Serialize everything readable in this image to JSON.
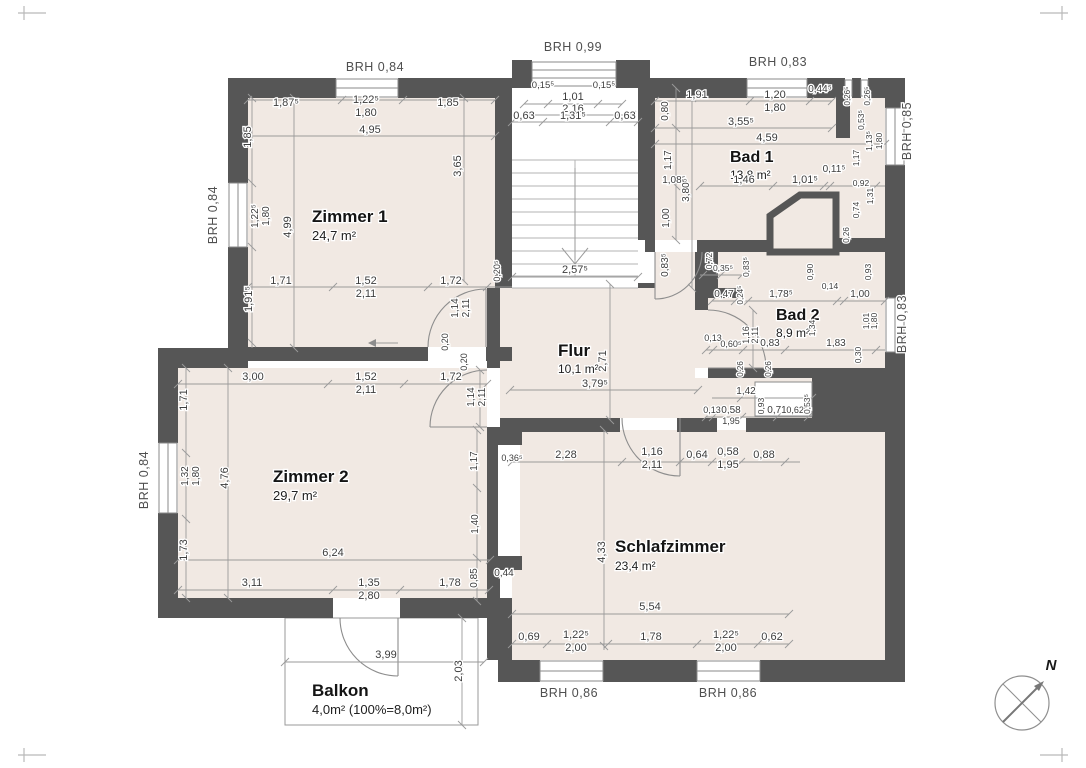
{
  "document_type": "floor-plan",
  "colors": {
    "wall": "#565656",
    "room_fill": "#f1e9e3",
    "dim_line": "#9a9a9a",
    "dim_text": "#3d3d3d",
    "paper": "#ffffff"
  },
  "rooms": [
    {
      "name": "Zimmer 1",
      "area": "24,7 m²"
    },
    {
      "name": "Zimmer 2",
      "area": "29,7 m²"
    },
    {
      "name": "Flur",
      "area": "10,1 m²"
    },
    {
      "name": "Bad 1",
      "area": "13,8 m²"
    },
    {
      "name": "Bad 2",
      "area": "8,9 m²"
    },
    {
      "name": "Schlafzimmer",
      "area": "23,4 m²"
    },
    {
      "name": "Balkon",
      "area": "4,0m² (100%=8,0m²)"
    }
  ],
  "plan": {
    "labels": [
      {
        "t": "Zimmer 1",
        "x": 312,
        "y": 222,
        "s": 17,
        "k": "room"
      },
      {
        "t": "24,7 m²",
        "x": 312,
        "y": 240,
        "s": 13,
        "k": "area"
      },
      {
        "t": "Zimmer 2",
        "x": 273,
        "y": 482,
        "s": 17,
        "k": "room"
      },
      {
        "t": "29,7 m²",
        "x": 273,
        "y": 500,
        "s": 13,
        "k": "area"
      },
      {
        "t": "Flur",
        "x": 558,
        "y": 356,
        "s": 17,
        "k": "room"
      },
      {
        "t": "10,1 m²",
        "x": 558,
        "y": 373,
        "s": 12,
        "k": "area"
      },
      {
        "t": "Bad 1",
        "x": 730,
        "y": 162,
        "s": 16,
        "k": "room"
      },
      {
        "t": "13,8 m²",
        "x": 730,
        "y": 179,
        "s": 12,
        "k": "area"
      },
      {
        "t": "Bad 2",
        "x": 776,
        "y": 320,
        "s": 16,
        "k": "room"
      },
      {
        "t": "8,9 m²",
        "x": 776,
        "y": 337,
        "s": 12,
        "k": "area"
      },
      {
        "t": "Schlafzimmer",
        "x": 615,
        "y": 552,
        "s": 17,
        "k": "room"
      },
      {
        "t": "23,4 m²",
        "x": 615,
        "y": 570,
        "s": 12,
        "k": "area"
      },
      {
        "t": "Balkon",
        "x": 312,
        "y": 696,
        "s": 17,
        "k": "room"
      },
      {
        "t": "4,0m² (100%=8,0m²)",
        "x": 312,
        "y": 714,
        "s": 13,
        "k": "area"
      },
      {
        "t": "BRH 0,84",
        "x": 375,
        "y": 71,
        "s": 12.5,
        "k": "brh"
      },
      {
        "t": "BRH 0,99",
        "x": 573,
        "y": 51,
        "s": 12.5,
        "k": "brh"
      },
      {
        "t": "BRH 0,83",
        "x": 778,
        "y": 66,
        "s": 12.5,
        "k": "brh"
      },
      {
        "t": "BRH 0,84",
        "x": 217,
        "y": 215,
        "r": 1,
        "s": 12.5,
        "k": "brh"
      },
      {
        "t": "BRH 0,84",
        "x": 148,
        "y": 480,
        "r": 1,
        "s": 12.5,
        "k": "brh"
      },
      {
        "t": "BRH 0,85",
        "x": 911,
        "y": 131,
        "r": 1,
        "s": 12.5,
        "k": "brh"
      },
      {
        "t": "BRH 0,83",
        "x": 906,
        "y": 324,
        "r": 1,
        "s": 12.5,
        "k": "brh"
      },
      {
        "t": "BRH 0,86",
        "x": 569,
        "y": 697,
        "s": 12.5,
        "k": "brh"
      },
      {
        "t": "BRH 0,86",
        "x": 728,
        "y": 697,
        "s": 12.5,
        "k": "brh"
      },
      {
        "t": "N",
        "x": 1051,
        "y": 670,
        "s": 15,
        "k": "compass"
      },
      {
        "t": "1,87⁵",
        "x": 286,
        "y": 106
      },
      {
        "t": "1,22⁵",
        "x": 366,
        "y": 103
      },
      {
        "t": "1,80",
        "x": 366,
        "y": 116
      },
      {
        "t": "1,85",
        "x": 448,
        "y": 106
      },
      {
        "t": "4,95",
        "x": 370,
        "y": 133
      },
      {
        "t": "1,85",
        "x": 251,
        "y": 137,
        "r": 1
      },
      {
        "t": "1,22⁵",
        "x": 258,
        "y": 216,
        "r": 1,
        "s": 10
      },
      {
        "t": "1,80",
        "x": 269,
        "y": 216,
        "r": 1,
        "s": 10
      },
      {
        "t": "4,99",
        "x": 291,
        "y": 227,
        "r": 1
      },
      {
        "t": "1,91⁵",
        "x": 252,
        "y": 299,
        "r": 1
      },
      {
        "t": "3,65",
        "x": 461,
        "y": 166,
        "r": 1
      },
      {
        "t": "1,71",
        "x": 281,
        "y": 284
      },
      {
        "t": "1,52",
        "x": 366,
        "y": 284
      },
      {
        "t": "2,11",
        "x": 366,
        "y": 297
      },
      {
        "t": "1,72",
        "x": 451,
        "y": 284
      },
      {
        "t": "1,14",
        "x": 458,
        "y": 308,
        "r": 1,
        "s": 10
      },
      {
        "t": "2,11",
        "x": 469,
        "y": 308,
        "r": 1,
        "s": 10
      },
      {
        "t": "0,20",
        "x": 448,
        "y": 342,
        "r": 1,
        "s": 9
      },
      {
        "t": "0,20",
        "x": 467,
        "y": 362,
        "r": 1,
        "s": 9
      },
      {
        "t": "0,20⁵",
        "x": 500,
        "y": 271,
        "r": 1,
        "s": 9
      },
      {
        "t": "0,15⁵",
        "x": 543,
        "y": 88,
        "s": 9.5
      },
      {
        "t": "0,15⁵",
        "x": 604,
        "y": 88,
        "s": 9.5
      },
      {
        "t": "1,01",
        "x": 573,
        "y": 100
      },
      {
        "t": "2,16",
        "x": 573,
        "y": 112
      },
      {
        "t": "0,63",
        "x": 524,
        "y": 119
      },
      {
        "t": "1,31⁵",
        "x": 573,
        "y": 119
      },
      {
        "t": "0,63",
        "x": 625,
        "y": 119
      },
      {
        "t": "2,57⁵",
        "x": 575,
        "y": 273
      },
      {
        "t": "2,71",
        "x": 606,
        "y": 361,
        "r": 1
      },
      {
        "t": "3,79⁵",
        "x": 595,
        "y": 387
      },
      {
        "t": "1,91",
        "x": 697,
        "y": 98
      },
      {
        "t": "0,80",
        "x": 668,
        "y": 111,
        "r": 1,
        "s": 10
      },
      {
        "t": "1,20",
        "x": 775,
        "y": 98
      },
      {
        "t": "1,80",
        "x": 775,
        "y": 111
      },
      {
        "t": "0,44⁵",
        "x": 820,
        "y": 92,
        "s": 10
      },
      {
        "t": "3,55⁵",
        "x": 741,
        "y": 125
      },
      {
        "t": "4,59",
        "x": 767,
        "y": 141
      },
      {
        "t": "1,17",
        "x": 671,
        "y": 160,
        "r": 1,
        "s": 10
      },
      {
        "t": "1,08⁵",
        "x": 674,
        "y": 183,
        "s": 10
      },
      {
        "t": "3,80⁵",
        "x": 689,
        "y": 190,
        "r": 1,
        "s": 10
      },
      {
        "t": "1,00",
        "x": 669,
        "y": 218,
        "r": 1,
        "s": 10
      },
      {
        "t": "1,46",
        "x": 744,
        "y": 183
      },
      {
        "t": "1,01⁵",
        "x": 805,
        "y": 183
      },
      {
        "t": "0,11⁵",
        "x": 834,
        "y": 172,
        "s": 10
      },
      {
        "t": "0,92",
        "x": 861,
        "y": 186,
        "s": 8.5
      },
      {
        "t": "1,31",
        "x": 873,
        "y": 196,
        "r": 1,
        "s": 8.5
      },
      {
        "t": "0,74",
        "x": 859,
        "y": 210,
        "r": 1,
        "s": 8.5
      },
      {
        "t": "0,26",
        "x": 849,
        "y": 235,
        "r": 1,
        "s": 8
      },
      {
        "t": "0,90",
        "x": 813,
        "y": 272,
        "r": 1,
        "s": 8.5
      },
      {
        "t": "0,93",
        "x": 871,
        "y": 272,
        "r": 1,
        "s": 8.5
      },
      {
        "t": "0,26⁵",
        "x": 850,
        "y": 96,
        "r": 1,
        "s": 8
      },
      {
        "t": "0,26⁵",
        "x": 870,
        "y": 96,
        "r": 1,
        "s": 8
      },
      {
        "t": "0,53⁵",
        "x": 864,
        "y": 120,
        "r": 1,
        "s": 8.5
      },
      {
        "t": "1,13⁵",
        "x": 872,
        "y": 141,
        "r": 1,
        "s": 8.5
      },
      {
        "t": "1,80",
        "x": 882,
        "y": 141,
        "r": 1,
        "s": 8.5
      },
      {
        "t": "1,17",
        "x": 859,
        "y": 158,
        "r": 1,
        "s": 8.5
      },
      {
        "t": "0,72",
        "x": 712,
        "y": 261,
        "r": 1,
        "s": 8.5
      },
      {
        "t": "0,35⁵",
        "x": 723,
        "y": 271,
        "s": 8.5
      },
      {
        "t": "0,83⁵",
        "x": 749,
        "y": 267,
        "r": 1,
        "s": 8.5
      },
      {
        "t": "0,83⁵",
        "x": 668,
        "y": 265,
        "r": 1,
        "s": 10
      },
      {
        "t": "0,47",
        "x": 724,
        "y": 297,
        "s": 10
      },
      {
        "t": "0,24⁵",
        "x": 743,
        "y": 295,
        "r": 1,
        "s": 8
      },
      {
        "t": "1,78⁵",
        "x": 781,
        "y": 297,
        "s": 10
      },
      {
        "t": "0,14",
        "x": 830,
        "y": 289,
        "s": 8.5
      },
      {
        "t": "1,00",
        "x": 860,
        "y": 297,
        "s": 10
      },
      {
        "t": "1,16",
        "x": 749,
        "y": 335,
        "r": 1,
        "s": 9
      },
      {
        "t": "2,11",
        "x": 758,
        "y": 335,
        "r": 1,
        "s": 9
      },
      {
        "t": "1,34",
        "x": 815,
        "y": 328,
        "r": 1,
        "s": 8.5
      },
      {
        "t": "1,01",
        "x": 869,
        "y": 321,
        "r": 1,
        "s": 8.5
      },
      {
        "t": "1,80",
        "x": 877,
        "y": 321,
        "r": 1,
        "s": 8.5
      },
      {
        "t": "0,13",
        "x": 713,
        "y": 341,
        "s": 9
      },
      {
        "t": "0,60⁵",
        "x": 731,
        "y": 347,
        "s": 9
      },
      {
        "t": "0,83",
        "x": 770,
        "y": 346,
        "s": 10
      },
      {
        "t": "1,83",
        "x": 836,
        "y": 346,
        "s": 10
      },
      {
        "t": "0,30",
        "x": 861,
        "y": 355,
        "r": 1,
        "s": 8.5
      },
      {
        "t": "0,26",
        "x": 743,
        "y": 369,
        "r": 1,
        "s": 8
      },
      {
        "t": "0,26",
        "x": 771,
        "y": 369,
        "r": 1,
        "s": 8
      },
      {
        "t": "1,42",
        "x": 746,
        "y": 394,
        "s": 10
      },
      {
        "t": "0,93",
        "x": 764,
        "y": 406,
        "r": 1,
        "s": 8.5
      },
      {
        "t": "0,71",
        "x": 777,
        "y": 413,
        "s": 10
      },
      {
        "t": "0,62⁵",
        "x": 797,
        "y": 413,
        "s": 9
      },
      {
        "t": "0,53⁵",
        "x": 810,
        "y": 404,
        "r": 1,
        "s": 8.5
      },
      {
        "t": "0,13",
        "x": 712,
        "y": 413,
        "s": 9
      },
      {
        "t": "0,58",
        "x": 731,
        "y": 413,
        "s": 10
      },
      {
        "t": "1,95",
        "x": 731,
        "y": 424,
        "s": 9
      },
      {
        "t": "2,28",
        "x": 566,
        "y": 458
      },
      {
        "t": "1,16",
        "x": 652,
        "y": 455
      },
      {
        "t": "2,11",
        "x": 652,
        "y": 468
      },
      {
        "t": "0,64",
        "x": 697,
        "y": 458
      },
      {
        "t": "0,58",
        "x": 728,
        "y": 455
      },
      {
        "t": "1,95",
        "x": 728,
        "y": 468
      },
      {
        "t": "0,88",
        "x": 764,
        "y": 458
      },
      {
        "t": "0,36⁵",
        "x": 512,
        "y": 461,
        "s": 9
      },
      {
        "t": "4,33",
        "x": 605,
        "y": 552,
        "r": 1
      },
      {
        "t": "5,54",
        "x": 650,
        "y": 610
      },
      {
        "t": "0,44",
        "x": 504,
        "y": 576,
        "s": 10
      },
      {
        "t": "1,17",
        "x": 477,
        "y": 461,
        "r": 1,
        "s": 10
      },
      {
        "t": "1,40",
        "x": 478,
        "y": 524,
        "r": 1,
        "s": 10
      },
      {
        "t": "0,85",
        "x": 477,
        "y": 578,
        "r": 1,
        "s": 10
      },
      {
        "t": "0,69",
        "x": 529,
        "y": 640
      },
      {
        "t": "1,22⁵",
        "x": 576,
        "y": 638
      },
      {
        "t": "2,00",
        "x": 576,
        "y": 651
      },
      {
        "t": "1,78",
        "x": 651,
        "y": 640
      },
      {
        "t": "1,22⁵",
        "x": 726,
        "y": 638
      },
      {
        "t": "2,00",
        "x": 726,
        "y": 651
      },
      {
        "t": "0,62",
        "x": 772,
        "y": 640
      },
      {
        "t": "3,00",
        "x": 253,
        "y": 380
      },
      {
        "t": "1,52",
        "x": 366,
        "y": 380
      },
      {
        "t": "2,11",
        "x": 366,
        "y": 393
      },
      {
        "t": "1,72",
        "x": 451,
        "y": 380
      },
      {
        "t": "1,14",
        "x": 474,
        "y": 397,
        "r": 1,
        "s": 10
      },
      {
        "t": "2,11",
        "x": 485,
        "y": 397,
        "r": 1,
        "s": 10
      },
      {
        "t": "1,71",
        "x": 187,
        "y": 400,
        "r": 1
      },
      {
        "t": "1,32",
        "x": 188,
        "y": 476,
        "r": 1,
        "s": 10
      },
      {
        "t": "1,80",
        "x": 199,
        "y": 476,
        "r": 1,
        "s": 10
      },
      {
        "t": "4,76",
        "x": 228,
        "y": 478,
        "r": 1
      },
      {
        "t": "1,73",
        "x": 187,
        "y": 550,
        "r": 1
      },
      {
        "t": "6,24",
        "x": 333,
        "y": 556
      },
      {
        "t": "3,11",
        "x": 252,
        "y": 586
      },
      {
        "t": "1,35",
        "x": 369,
        "y": 586
      },
      {
        "t": "2,80",
        "x": 369,
        "y": 599
      },
      {
        "t": "1,78",
        "x": 450,
        "y": 586
      },
      {
        "t": "3,99",
        "x": 386,
        "y": 658
      },
      {
        "t": "2,03",
        "x": 462,
        "y": 671,
        "r": 1
      }
    ],
    "dimlines": {
      "h": [
        [
          100,
          248,
          495,
          [
            248,
            342,
            403,
            495
          ]
        ],
        [
          136,
          248,
          495,
          [
            248,
            495
          ]
        ],
        [
          104,
          524,
          622,
          [
            524,
            548,
            598,
            622
          ]
        ],
        [
          115,
          524,
          632,
          [
            524,
            632
          ]
        ],
        [
          122,
          512,
          638,
          [
            512,
            543,
            610,
            638
          ]
        ],
        [
          101,
          655,
          832,
          [
            655,
            750,
            810,
            832
          ]
        ],
        [
          128,
          655,
          832,
          [
            655,
            832
          ]
        ],
        [
          144,
          655,
          885,
          [
            655,
            885
          ]
        ],
        [
          186,
          700,
          885,
          [
            700,
            773,
            824,
            830,
            876
          ]
        ],
        [
          287,
          248,
          512,
          [
            248,
            333,
            428,
            487
          ]
        ],
        [
          277,
          512,
          638,
          [
            512,
            638
          ]
        ],
        [
          390,
          510,
          698,
          [
            510,
            698
          ]
        ],
        [
          384,
          178,
          487,
          [
            178,
            328,
            404,
            487
          ]
        ],
        [
          462,
          512,
          800,
          [
            512,
            622,
            680,
            712,
            741,
            785
          ]
        ],
        [
          614,
          512,
          789,
          [
            512,
            789
          ]
        ],
        [
          644,
          512,
          789,
          [
            512,
            547,
            608,
            697,
            758,
            789
          ]
        ],
        [
          560,
          178,
          490,
          [
            178,
            490
          ]
        ],
        [
          590,
          178,
          489,
          [
            178,
            333,
            400,
            489
          ]
        ],
        [
          662,
          285,
          484,
          [
            285,
            484
          ]
        ],
        [
          301,
          712,
          885,
          [
            712,
            735,
            748,
            837,
            844,
            885
          ]
        ],
        [
          350,
          706,
          885,
          [
            706,
            713,
            743,
            785,
            876
          ]
        ],
        [
          398,
          712,
          812,
          [
            741,
            812
          ]
        ],
        [
          417,
          706,
          812,
          [
            706,
            713,
            742,
            777,
            808
          ]
        ],
        [
          275,
          700,
          742,
          [
            703,
            721,
            742
          ]
        ]
      ],
      "v": [
        [
          252,
          98,
          348,
          [
            98,
            183,
            247,
            343
          ]
        ],
        [
          294,
          98,
          348,
          [
            98,
            348
          ]
        ],
        [
          464,
          98,
          281,
          [
            98,
            281
          ]
        ],
        [
          610,
          284,
          420,
          [
            284,
            420
          ]
        ],
        [
          676,
          88,
          240,
          [
            88,
            128,
            186,
            240
          ]
        ],
        [
          692,
          98,
          288,
          [
            98,
            288
          ]
        ],
        [
          186,
          368,
          598,
          [
            368,
            453,
            519,
            598
          ]
        ],
        [
          228,
          368,
          598,
          [
            368,
            598
          ]
        ],
        [
          477,
          430,
          601,
          [
            430,
            488,
            558,
            601
          ]
        ],
        [
          604,
          430,
          650,
          [
            430,
            646
          ]
        ],
        [
          462,
          618,
          725,
          [
            618,
            725
          ]
        ],
        [
          753,
          310,
          368,
          [
            310,
            368
          ]
        ],
        [
          480,
          370,
          427,
          [
            370,
            427
          ]
        ]
      ]
    }
  }
}
